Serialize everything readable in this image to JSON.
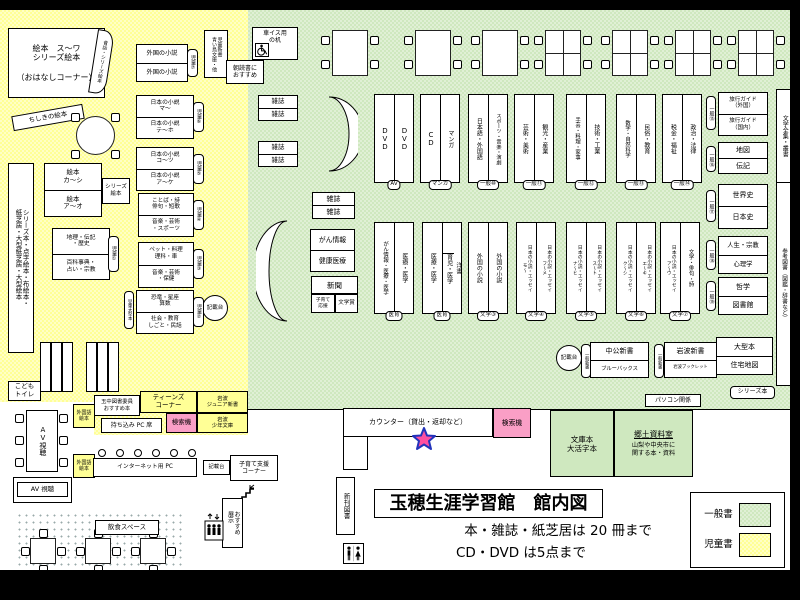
{
  "map": {
    "title": "玉穂生涯学習館　館内図",
    "note1": "本・雑誌・紙芝居は 20 冊まで",
    "note2": "CD・DVD は5点まで",
    "legend": {
      "general": "一般書",
      "children": "児童書"
    },
    "colors": {
      "general_area": "#cfe8bf",
      "children_area": "#ffff96",
      "search_pink": "#fa9fc6"
    }
  },
  "children": {
    "ohanashi": "絵本　ス〜ワ\nシリーズ絵本\n\n（おはなしコーナー）",
    "mukashi_band": "昔話・シリーズ絵本",
    "chishiki": "ちしきの絵本",
    "left_strip": "シリーズ本・点字絵本・布絵本・\n紙芝居・大型紙芝居・大型絵本",
    "ehon": {
      "top": "絵本\nカ〜シ",
      "bottom": "絵本\nア〜オ"
    },
    "series_ehon": "シリーズ\n絵本",
    "geo": {
      "top": "地理・伝記\n・歴史",
      "bottom": "百科事典・\n占い・宗教",
      "tag": "児童①"
    },
    "foreign": {
      "top": "外国の小説",
      "bottom": "外国の小説",
      "tag": "児童⑦"
    },
    "jfic_ma": {
      "top": "日本の小説\nマ〜",
      "bottom": "日本の小説\nテ〜ホ",
      "tag": "児童⑥"
    },
    "jfic_ko": {
      "top": "日本の小説\nコ〜ツ",
      "bottom": "日本の小説\nア〜ケ",
      "tag": "児童⑤"
    },
    "kotoba": {
      "top": "ことば・詩\n俳句・短歌",
      "bottom": "音楽・芸術\n・スポーツ",
      "tag": "児童④"
    },
    "pet": {
      "top": "ペット・料理\n理科・車",
      "bottom": "音楽・芸術\n・保健",
      "tag": "児童③"
    },
    "dino": {
      "top": "恐竜・星座\n算数",
      "bottom": "社会・教育\nしごと・民話",
      "tag": "児童②"
    },
    "ogata_tag": "児童大型本",
    "kisaidai": "記載台",
    "jnewbook": "児童新書\n青い鳥文庫・他",
    "asadoku": "朝読書に\nおすすめ",
    "toilet": "こども\nトイレ"
  },
  "general": {
    "zasshi": "雑誌",
    "wheelchair_desk": "車イス用\nの机",
    "row1": [
      {
        "left": "DVD",
        "right": "DVD",
        "tag": "AV"
      },
      {
        "left": "CD",
        "right": "マンガ",
        "tag": "マンガ"
      },
      {
        "left": "日本語・外国語",
        "right": "スポーツ・音楽・演劇",
        "tag": "一般⑩"
      },
      {
        "left": "芸術・美術",
        "right": "観光・産業",
        "tag": "一般⑪"
      },
      {
        "left": "手芸・料理・家事",
        "right": "技術・工業",
        "tag": "一般⑫"
      },
      {
        "left": "数学・自然科学",
        "right": "民俗・教育",
        "tag": "一般⑬"
      },
      {
        "left": "税金・福祉",
        "right": "政治・法律",
        "tag": "一般⑭"
      }
    ],
    "row2": [
      {
        "left": "がん情報・医療・医学",
        "right": "医療・医学",
        "tag": "医育"
      },
      {
        "left": "医療・医学",
        "right_top": "洋書",
        "right_bottom": "育児・医学",
        "tag": "医育"
      },
      {
        "left": "外国の小説",
        "right": "外国の小説",
        "tag": "文学③"
      },
      {
        "left": "日本の小説・エッセイ\nモ〜",
        "right": "日本の小説・エッセイ\nフ〜メ",
        "tag": "文学④"
      },
      {
        "left": "日本の小説・エッセイ\nナ〜ヒ",
        "right": "日本の小説・エッセイ\nス〜ト",
        "tag": "文学⑤"
      },
      {
        "left": "日本の小説・エッセイ\nク〜シ",
        "right": "日本の小説・エッセイ\nエ〜キ",
        "tag": "文学⑥"
      },
      {
        "left": "日本の小説・エッセイ\nア〜ウ",
        "right": "文学・俳句・詩",
        "tag": "文学⑦"
      }
    ],
    "side": [
      {
        "top": "旅行ガイド\n（外国）",
        "bottom": "旅行ガイド\n（国内）",
        "tag": "一般⑮"
      },
      {
        "top": "地図",
        "bottom": "伝記",
        "tag": "一般⑯"
      },
      {
        "top": "世界史",
        "bottom": "日本史",
        "tag": "一般⑰"
      },
      {
        "top": "人生・宗教",
        "bottom": "心理学",
        "tag": "一般⑱"
      },
      {
        "top": "哲学",
        "bottom": "図書館",
        "tag": "一般⑲"
      },
      {
        "top": "大型本",
        "bottom": "住宅地図",
        "tag": ""
      }
    ],
    "strip_bungaku": "文学全集・叢書",
    "strip_sanko": "参考図書（図鑑・辞書など）",
    "series_tag": "シリーズ本",
    "gan": "がん情報",
    "kenko": "健康医療",
    "shinbun": "新聞",
    "kosodate_ouen": "子育て\n応援",
    "bungaku_sho": "文学賞",
    "shinsho": [
      {
        "tag": "一般新書",
        "top": "中公新書",
        "bottom": "ブルーバックス"
      },
      {
        "tag": "一般新書",
        "top": "岩波新書",
        "bottom": "岩波ブックレット"
      }
    ],
    "pasokon": "パソコン関係",
    "kisaidai": "記載台"
  },
  "south": {
    "counter": "カウンター（貸出・返却など）",
    "kensakuki": "検索機",
    "bunko": "文庫本\n大活字本",
    "kyodo_title": "郷土資料室",
    "kyodo_sub": "山梨や中央市に\n関する本・資料",
    "shinkan": "新刊図書",
    "av_table": "AV視聴",
    "av_shelf": "AV 視聴",
    "foreign_ehon": "外国語\n絵本",
    "tamachu": "玉中図書委員\nおすすめ本",
    "teens": "ティーンズ\nコーナー",
    "iwanami_junior": "岩波\nジュニア新書",
    "iwanami_shonen": "岩波\n少年文庫",
    "pc_seat": "持ち込み PC 席",
    "internet_pc": "インターネット用 PC",
    "kisaidai": "記載台",
    "kosodate_shien": "子育て支援\nコーナー",
    "osusume": "おすすめ\n展示",
    "inshoku": "飲食スペース"
  }
}
